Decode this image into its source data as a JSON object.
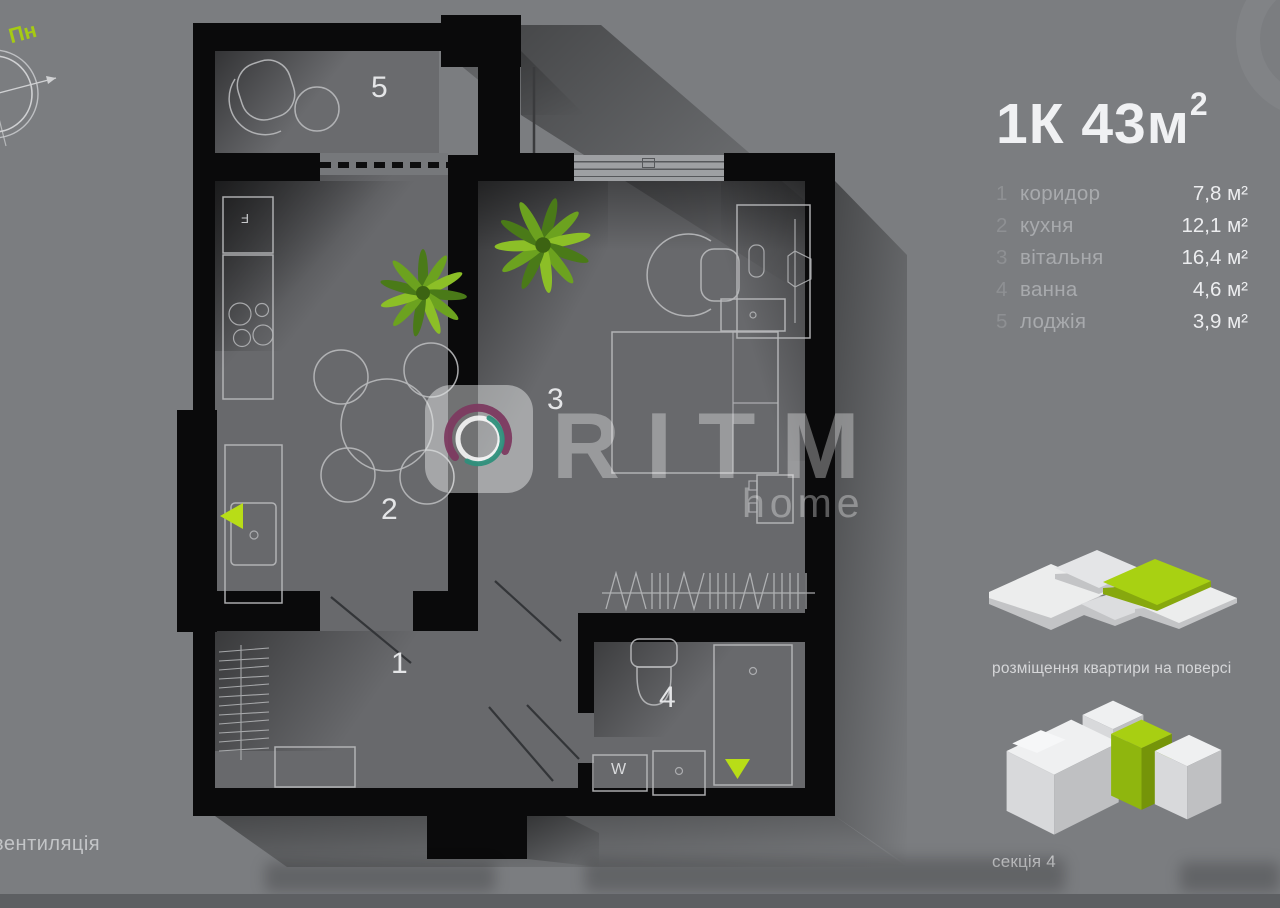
{
  "header": {
    "title_main": "1К 43м",
    "title_sup": "2"
  },
  "rooms": [
    {
      "number": "1",
      "name": "коридор",
      "area": "7,8 м²"
    },
    {
      "number": "2",
      "name": "кухня",
      "area": "12,1 м²"
    },
    {
      "number": "3",
      "name": "вітальня",
      "area": "16,4 м²"
    },
    {
      "number": "4",
      "name": "ванна",
      "area": "4,6 м²"
    },
    {
      "number": "5",
      "name": "лоджія",
      "area": "3,9 м²"
    }
  ],
  "watermark": {
    "brand": "RITM",
    "sub": "home"
  },
  "annotations": {
    "north": "Пн",
    "ventilation": "вентиляція",
    "washer": "W",
    "fridge": "F"
  },
  "captions": {
    "placement": "розміщення квартири на поверсі",
    "section": "секція 4"
  },
  "colors": {
    "accent": "#a6cb13",
    "background": "#7b7d80",
    "wall": "#0a0a0b",
    "floor": "#68696c",
    "furniture_line": "#b7b9bb"
  }
}
